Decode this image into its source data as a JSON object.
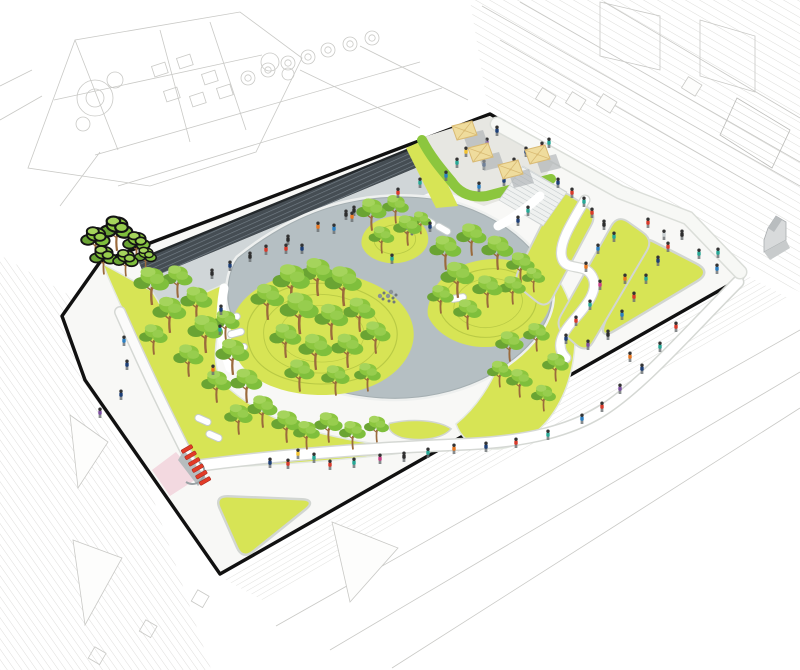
{
  "palette": {
    "boundary": "#111111",
    "sitePaving": "#f8f8f6",
    "walkway": "#d0d6d8",
    "stairsDark": "#454d53",
    "stairsStripe": "#76818a",
    "plaza": "#b5bfc3",
    "plazaEdge": "#a5afb2",
    "lawn": "#d7e455",
    "contour": "#b9ca45",
    "treeDark": "#6aa433",
    "treeMid": "#8cc63f",
    "treeLight": "#a5d45c",
    "trunk": "#9a6a3c",
    "hedgeBand": "#8cc63e",
    "umbrella": "#efdc9d",
    "umbrellaLine": "#d9ba73",
    "umbrellaShadow": "#a9aeb0",
    "benchWhite": "#ffffff",
    "red": "#e23b27",
    "pink": "#f3d9e0",
    "pathWhite": "#ffffff",
    "pathCasing": "#d5d8d4",
    "tableGray": "#70787c",
    "contextLine": "#c9c9c6"
  },
  "scene": {
    "umbrellas": [
      [
        461,
        132
      ],
      [
        477,
        154
      ],
      [
        507,
        171
      ],
      [
        534,
        156
      ]
    ],
    "tableClusters": [
      [
        388,
        296
      ],
      [
        406,
        228
      ]
    ],
    "benches": [
      [
        232,
        318,
        -18
      ],
      [
        236,
        333,
        -15
      ],
      [
        239,
        348,
        -12
      ],
      [
        203,
        420,
        24
      ],
      [
        214,
        436,
        24
      ],
      [
        428,
        221,
        30
      ],
      [
        443,
        229,
        30
      ],
      [
        458,
        298,
        -10
      ]
    ],
    "redModules": [
      [
        187,
        449
      ],
      [
        190.6,
        455.4
      ],
      [
        194.2,
        461.8
      ],
      [
        197.8,
        468.2
      ],
      [
        201.4,
        474.6
      ],
      [
        205,
        481
      ]
    ],
    "lawnTriangles": [
      {
        "pts": [
          [
            640,
            236
          ],
          [
            710,
            272
          ],
          [
            600,
            338
          ]
        ],
        "r": 16
      },
      {
        "pts": [
          [
            216,
            497
          ],
          [
            314,
            501
          ],
          [
            243,
            558
          ]
        ],
        "r": 12
      }
    ],
    "lawnStripes": [
      {
        "pts": [
          [
            560,
            190
          ],
          [
            596,
            214
          ],
          [
            546,
            308
          ],
          [
            514,
            282
          ]
        ],
        "r": 12
      },
      {
        "pts": [
          [
            618,
            216
          ],
          [
            652,
            240
          ],
          [
            586,
            352
          ],
          [
            556,
            326
          ]
        ],
        "r": 12
      }
    ],
    "lawnSliver": "M390,424 C412,419 438,421 450,429 C442,438 420,441 402,437 C393,434 388,429 390,424 Z",
    "trees": [
      [
        96,
        256,
        0.8,
        1
      ],
      [
        117,
        249,
        0.9,
        1
      ],
      [
        137,
        259,
        0.75,
        1
      ],
      [
        104,
        273,
        0.75,
        1
      ],
      [
        126,
        275,
        0.7,
        1
      ],
      [
        146,
        269,
        0.6,
        1
      ],
      [
        152,
        303,
        1.0
      ],
      [
        178,
        296,
        0.85
      ],
      [
        170,
        331,
        0.95
      ],
      [
        154,
        353,
        0.8
      ],
      [
        197,
        319,
        0.9
      ],
      [
        206,
        351,
        1.0
      ],
      [
        189,
        375,
        0.85
      ],
      [
        226,
        339,
        0.8
      ],
      [
        233,
        373,
        0.95
      ],
      [
        217,
        401,
        0.85
      ],
      [
        247,
        401,
        0.9
      ],
      [
        263,
        426,
        0.85
      ],
      [
        239,
        433,
        0.8
      ],
      [
        287,
        441,
        0.85
      ],
      [
        307,
        448,
        0.75
      ],
      [
        329,
        441,
        0.8
      ],
      [
        353,
        448,
        0.75
      ],
      [
        377,
        441,
        0.7
      ],
      [
        268,
        318,
        0.95
      ],
      [
        292,
        302,
        1.05
      ],
      [
        318,
        294,
        1.0
      ],
      [
        344,
        304,
        1.05
      ],
      [
        300,
        332,
        1.1
      ],
      [
        332,
        338,
        0.95
      ],
      [
        360,
        330,
        0.9
      ],
      [
        286,
        356,
        0.9
      ],
      [
        316,
        368,
        0.95
      ],
      [
        348,
        366,
        0.9
      ],
      [
        376,
        352,
        0.85
      ],
      [
        300,
        390,
        0.85
      ],
      [
        336,
        394,
        0.8
      ],
      [
        368,
        390,
        0.75
      ],
      [
        372,
        229,
        0.85
      ],
      [
        396,
        222,
        0.75
      ],
      [
        408,
        244,
        0.8
      ],
      [
        382,
        252,
        0.72
      ],
      [
        421,
        233,
        0.6
      ],
      [
        446,
        268,
        0.9
      ],
      [
        472,
        254,
        0.85
      ],
      [
        498,
        268,
        0.9
      ],
      [
        521,
        281,
        0.8
      ],
      [
        458,
        296,
        0.95
      ],
      [
        488,
        306,
        0.85
      ],
      [
        513,
        303,
        0.75
      ],
      [
        468,
        328,
        0.8
      ],
      [
        441,
        312,
        0.75
      ],
      [
        534,
        291,
        0.65
      ],
      [
        510,
        360,
        0.8
      ],
      [
        537,
        350,
        0.75
      ],
      [
        556,
        380,
        0.75
      ],
      [
        520,
        396,
        0.75
      ],
      [
        544,
        410,
        0.7
      ],
      [
        500,
        386,
        0.7
      ]
    ],
    "people": [
      [
        212,
        277,
        "#2c2c2c"
      ],
      [
        230,
        269,
        "#1d3f77"
      ],
      [
        250,
        260,
        "#2c2c2c"
      ],
      [
        266,
        253,
        "#d93a2b"
      ],
      [
        288,
        243,
        "#2c2c2c"
      ],
      [
        318,
        230,
        "#e87722"
      ],
      [
        346,
        218,
        "#2c2c2c"
      ],
      [
        354,
        214,
        "#2c2c2c"
      ],
      [
        398,
        196,
        "#d93a2b"
      ],
      [
        420,
        186,
        "#27a896"
      ],
      [
        470,
        130,
        "#d93a2b"
      ],
      [
        497,
        134,
        "#1d3f77"
      ],
      [
        487,
        146,
        "#7c4fa0"
      ],
      [
        466,
        155,
        "#f2c230"
      ],
      [
        457,
        166,
        "#27a896"
      ],
      [
        484,
        168,
        "#1d3f77"
      ],
      [
        479,
        190,
        "#2b7fc2"
      ],
      [
        504,
        184,
        "#1d3f77"
      ],
      [
        514,
        166,
        "#d93a2b"
      ],
      [
        526,
        155,
        "#1d3f77"
      ],
      [
        542,
        150,
        "#d93a2b"
      ],
      [
        549,
        146,
        "#27a896"
      ],
      [
        446,
        179,
        "#2b7fc2"
      ],
      [
        558,
        186,
        "#1d3f77"
      ],
      [
        572,
        196,
        "#d93a2b"
      ],
      [
        584,
        205,
        "#27a896"
      ],
      [
        528,
        214,
        "#27a896"
      ],
      [
        518,
        224,
        "#1d3f77"
      ],
      [
        592,
        216,
        "#d93a2b"
      ],
      [
        604,
        228,
        "#2c2c2c"
      ],
      [
        614,
        240,
        "#27a896"
      ],
      [
        598,
        252,
        "#2b7fc2"
      ],
      [
        586,
        270,
        "#e87722"
      ],
      [
        600,
        288,
        "#c93f87"
      ],
      [
        590,
        308,
        "#27a896"
      ],
      [
        576,
        324,
        "#d93a2b"
      ],
      [
        566,
        342,
        "#1d3f77"
      ],
      [
        588,
        348,
        "#7c4fa0"
      ],
      [
        608,
        338,
        "#2c2c2c"
      ],
      [
        622,
        318,
        "#2b7fc2"
      ],
      [
        634,
        300,
        "#d93a2b"
      ],
      [
        646,
        282,
        "#27a896"
      ],
      [
        658,
        264,
        "#1d3f77"
      ],
      [
        668,
        250,
        "#d93a2b"
      ],
      [
        682,
        238,
        "#2c2c2c"
      ],
      [
        648,
        226,
        "#d93a2b"
      ],
      [
        664,
        238,
        "#c9cfd1"
      ],
      [
        699,
        257,
        "#27a896"
      ],
      [
        718,
        256,
        "#27a896"
      ],
      [
        717,
        272,
        "#2b7fc2"
      ],
      [
        625,
        282,
        "#e87722"
      ],
      [
        676,
        330,
        "#d93a2b"
      ],
      [
        660,
        350,
        "#27a896"
      ],
      [
        642,
        372,
        "#1d3f77"
      ],
      [
        620,
        392,
        "#7c4fa0"
      ],
      [
        602,
        410,
        "#d93a2b"
      ],
      [
        582,
        422,
        "#2b7fc2"
      ],
      [
        630,
        360,
        "#e87722"
      ],
      [
        548,
        438,
        "#27a896"
      ],
      [
        516,
        446,
        "#d93a2b"
      ],
      [
        486,
        450,
        "#1d3f77"
      ],
      [
        454,
        452,
        "#e87722"
      ],
      [
        428,
        456,
        "#27a896"
      ],
      [
        404,
        460,
        "#2c2c2c"
      ],
      [
        380,
        462,
        "#c93f87"
      ],
      [
        354,
        466,
        "#27a896"
      ],
      [
        330,
        468,
        "#d93a2b"
      ],
      [
        314,
        461,
        "#27a896"
      ],
      [
        298,
        457,
        "#f2c230"
      ],
      [
        288,
        467,
        "#d93a2b"
      ],
      [
        270,
        466,
        "#1d3f77"
      ],
      [
        352,
        220,
        "#e87722"
      ],
      [
        334,
        232,
        "#2b7fc2"
      ],
      [
        302,
        252,
        "#1d3f77"
      ],
      [
        286,
        252,
        "#d93a2b"
      ],
      [
        392,
        262,
        "#27a896"
      ],
      [
        430,
        230,
        "#1d3f77"
      ],
      [
        221,
        313,
        "#1d3f77"
      ],
      [
        220,
        333,
        "#27a896"
      ],
      [
        124,
        344,
        "#2b7fc2"
      ],
      [
        127,
        368,
        "#1d3f77"
      ],
      [
        121,
        398,
        "#1d3f77"
      ],
      [
        100,
        416,
        "#7c4fa0"
      ],
      [
        213,
        373,
        "#e87722"
      ]
    ]
  }
}
